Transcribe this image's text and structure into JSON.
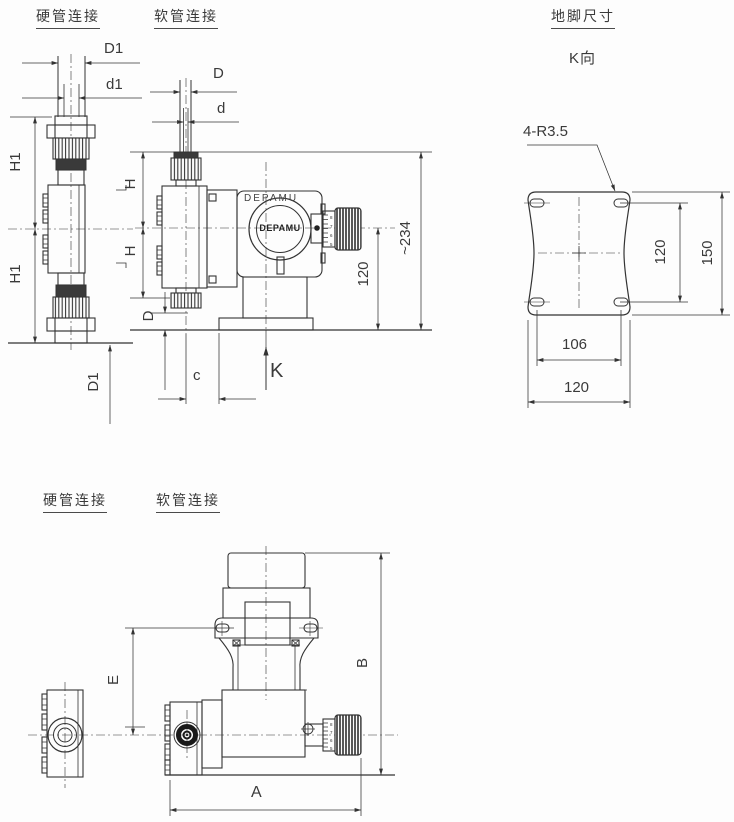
{
  "labels": {
    "hard_top": "硬管连接",
    "soft_top": "软管连接",
    "foundation": "地脚尺寸",
    "k_dir": "K向",
    "hard_bottom": "硬管连接",
    "soft_bottom": "软管连接",
    "brand_body": "DEPAMU",
    "brand_dial": "DEPAMU"
  },
  "dims": {
    "D1": "D1",
    "d1": "d1",
    "D": "D",
    "d": "d",
    "H1": "H1",
    "H": "H",
    "total": "~234",
    "center_to_base": "120",
    "c": "c",
    "K": "K",
    "slot_note": "4-R3.5",
    "fv_inner": "120",
    "fv_outer": "150",
    "fh_inner": "106",
    "fh_outer": "120",
    "E": "E",
    "B": "B",
    "A": "A"
  },
  "knob": {
    "digits": [
      "8",
      "7",
      "6",
      "5"
    ]
  },
  "colors": {
    "line": "#333333",
    "dark_fill": "#3a3a3a",
    "bg": "#fdfdfd"
  }
}
